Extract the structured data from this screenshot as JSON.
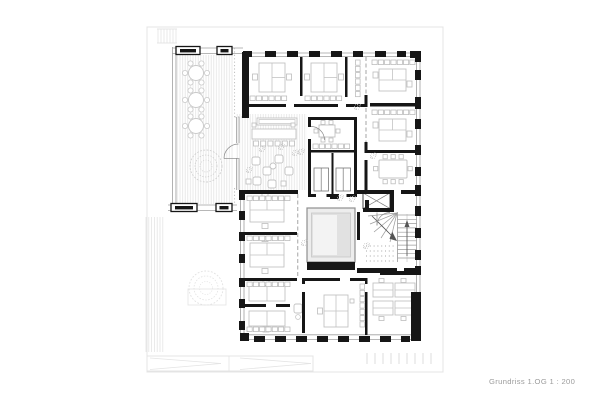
{
  "caption": {
    "text": "Grundriss 1.OG 1 : 200"
  },
  "colors": {
    "wall": "#161616",
    "glazing": "#9f9f9f",
    "furniture": "#c3c3c3",
    "chair": "#bdbdbd",
    "shelf": "#b5b5b5",
    "faint_site": "#e4e4e4",
    "deck_hatch": "#e4e4e4",
    "atrium_frame": "#8f8f8f",
    "atrium_fill": "#ededed",
    "atrium_inner": "#e1e1e1",
    "stair_line": "#9a9a9a",
    "plant": "#c4c4c4",
    "caption_text": "#9b9b9b"
  }
}
